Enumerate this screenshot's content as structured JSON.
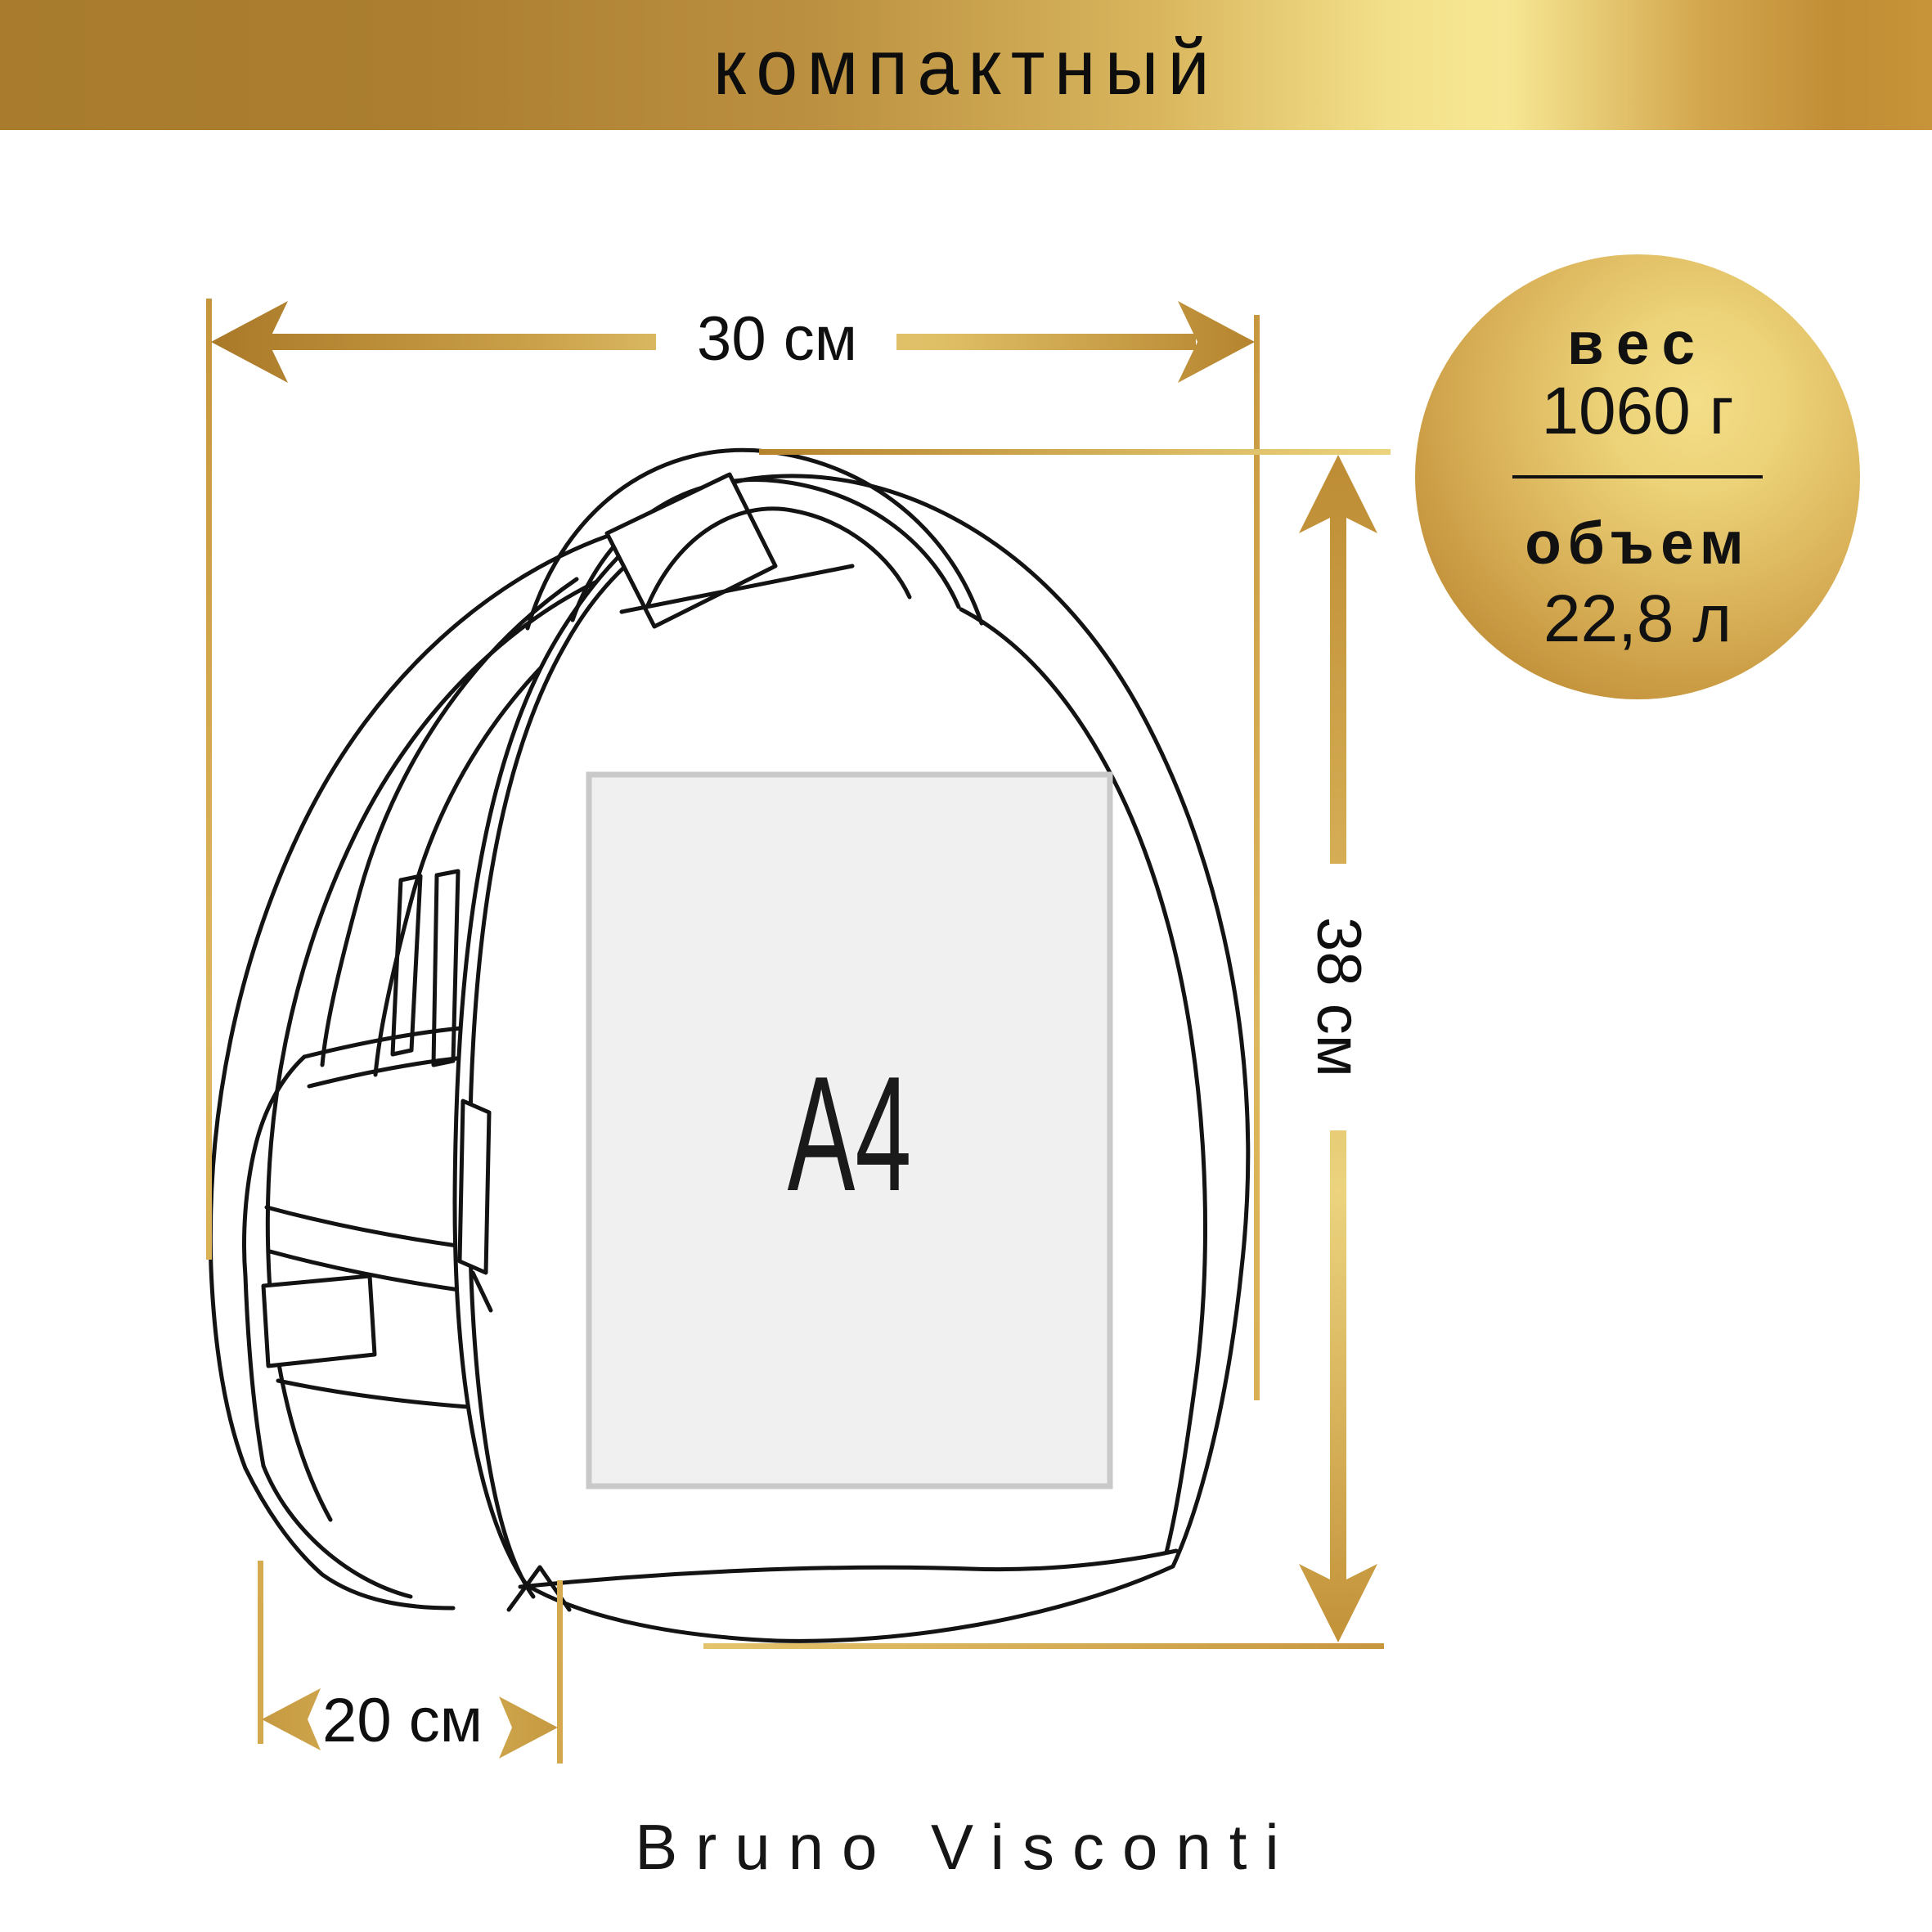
{
  "banner": {
    "label": "компактный"
  },
  "badge": {
    "weight_label": "вес",
    "weight_value": "1060 г",
    "volume_label": "объем",
    "volume_value": "22,8 л"
  },
  "dimensions": {
    "width_label": "30 см",
    "height_label": "38 см",
    "depth_label": "20 см"
  },
  "paper": {
    "label": "А4"
  },
  "brand": {
    "name": "Bruno Visconti"
  },
  "colors": {
    "gold_dark": "#a87b2d",
    "gold_mid": "#d9b65e",
    "gold_light": "#f7e794",
    "line_black": "#131313",
    "paper_fill": "#f0f0f0",
    "paper_border": "#c9c9c9"
  }
}
